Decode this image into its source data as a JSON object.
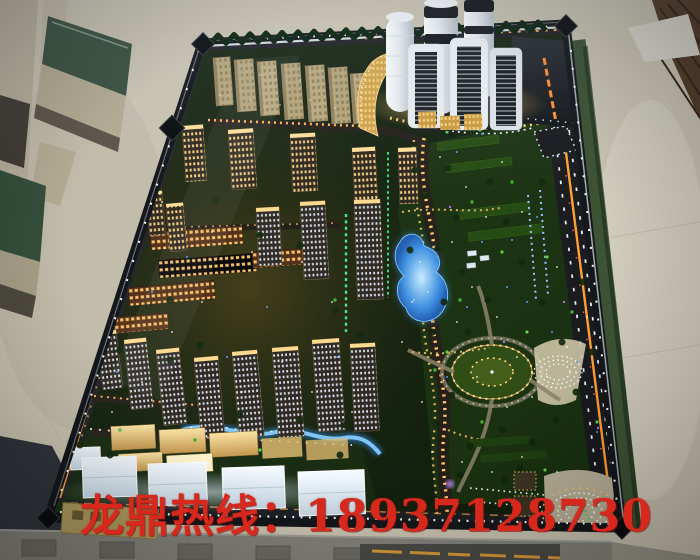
{
  "overlay": {
    "hotline_text": "龙鼎热线：18937128730"
  },
  "palette": {
    "hotline_red": "#d6281c",
    "floor_beige": "#c9c3b1",
    "model_base": "#0f1d0b",
    "park_green": "#172f0e",
    "window_gold": "#ffd98a",
    "road_amber": "#ff9e32",
    "lake_blue": "#2f93e8",
    "tower_white": "#eef2f5",
    "wood_brown": "#503823"
  }
}
